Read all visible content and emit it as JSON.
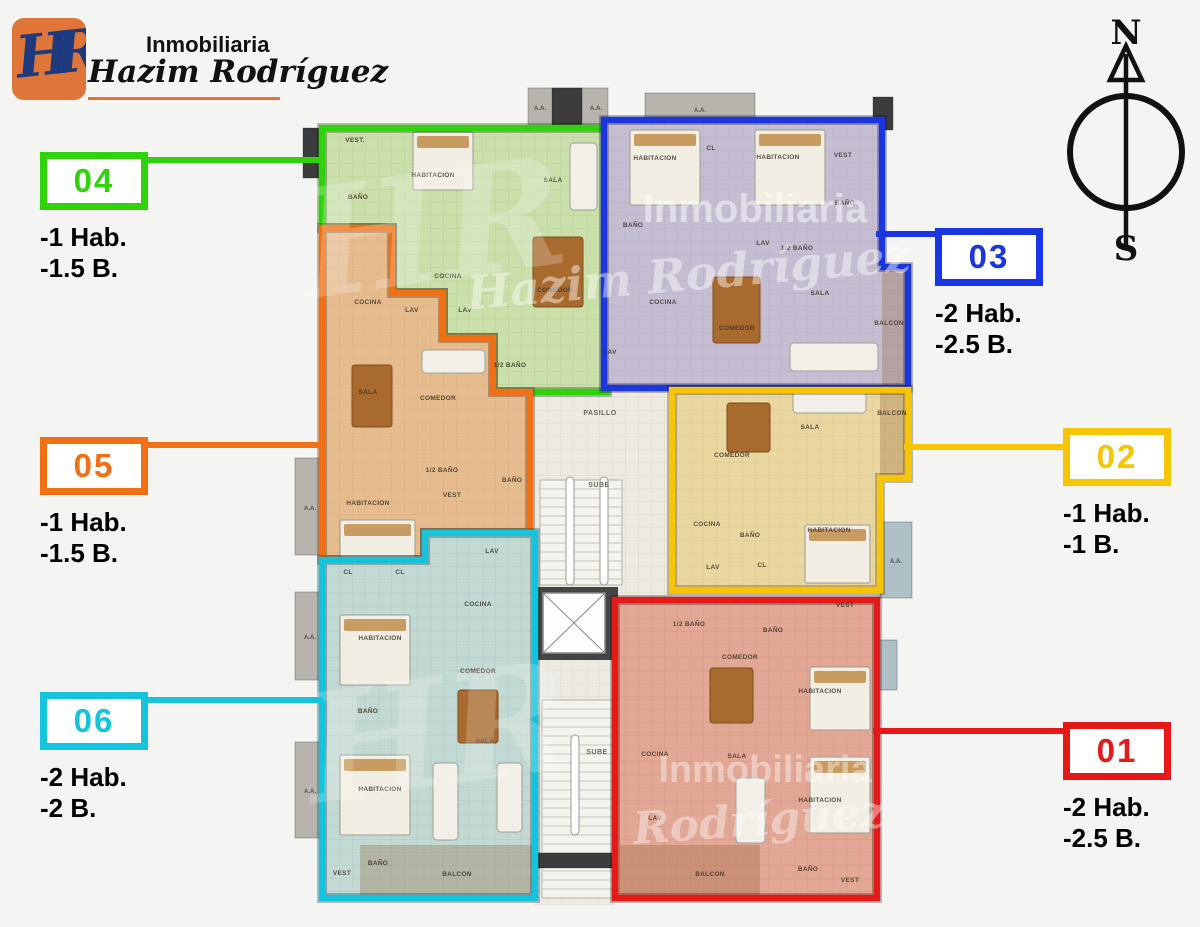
{
  "brand": {
    "monogram": "HR",
    "line1": "Inmobiliaria",
    "line2": "Hazim Rodríguez"
  },
  "compass": {
    "north": "N",
    "south": "S"
  },
  "units": {
    "01": {
      "id": "01",
      "hab": "-2 Hab.",
      "bath": "-2.5 B.",
      "color": "#e51a18",
      "fill": "#e2a795",
      "outline": "315,515 577,515 577,813 315,813",
      "rooms": [
        {
          "name": "1/2 BAÑO",
          "x": 389,
          "y": 541
        },
        {
          "name": "BAÑO",
          "x": 473,
          "y": 547
        },
        {
          "name": "VEST",
          "x": 545,
          "y": 522
        },
        {
          "name": "COMEDOR",
          "x": 440,
          "y": 574
        },
        {
          "name": "HABITACION",
          "x": 520,
          "y": 608
        },
        {
          "name": "COCINA",
          "x": 355,
          "y": 671
        },
        {
          "name": "SALA",
          "x": 437,
          "y": 673
        },
        {
          "name": "LAV",
          "x": 355,
          "y": 735
        },
        {
          "name": "HABITACION",
          "x": 520,
          "y": 717
        },
        {
          "name": "BALCON",
          "x": 410,
          "y": 791
        },
        {
          "name": "BAÑO",
          "x": 508,
          "y": 786
        },
        {
          "name": "VEST",
          "x": 550,
          "y": 797
        }
      ]
    },
    "02": {
      "id": "02",
      "hab": "-1 Hab.",
      "bath": "-1 B.",
      "color": "#f7c506",
      "fill": "#ead7a0",
      "outline": "372,305 608,305 608,393 580,393 580,505 372,505",
      "rooms": [
        {
          "name": "COMEDOR",
          "x": 432,
          "y": 372
        },
        {
          "name": "SALA",
          "x": 510,
          "y": 344
        },
        {
          "name": "BALCON",
          "x": 592,
          "y": 330
        },
        {
          "name": "COCINA",
          "x": 407,
          "y": 441
        },
        {
          "name": "BAÑO",
          "x": 450,
          "y": 452
        },
        {
          "name": "LAV",
          "x": 413,
          "y": 484
        },
        {
          "name": "CL",
          "x": 462,
          "y": 482
        },
        {
          "name": "HABITACION",
          "x": 529,
          "y": 447
        }
      ]
    },
    "03": {
      "id": "03",
      "hab": "-2 Hab.",
      "bath": "-2.5 B.",
      "color": "#1a36e0",
      "fill": "#c5bed2",
      "outline": "304,35 582,35 582,182 608,182 608,303 304,303",
      "rooms": [
        {
          "name": "HABITACION",
          "x": 355,
          "y": 75
        },
        {
          "name": "CL",
          "x": 411,
          "y": 65
        },
        {
          "name": "HABITACION",
          "x": 478,
          "y": 74
        },
        {
          "name": "VEST",
          "x": 543,
          "y": 72
        },
        {
          "name": "BAÑO",
          "x": 333,
          "y": 142
        },
        {
          "name": "BAÑO",
          "x": 545,
          "y": 120
        },
        {
          "name": "LAV",
          "x": 463,
          "y": 160
        },
        {
          "name": "1/2 BAÑO",
          "x": 497,
          "y": 165
        },
        {
          "name": "COCINA",
          "x": 363,
          "y": 219
        },
        {
          "name": "COMEDOR",
          "x": 437,
          "y": 245
        },
        {
          "name": "SALA",
          "x": 520,
          "y": 210
        },
        {
          "name": "BALCON",
          "x": 589,
          "y": 240
        },
        {
          "name": "LAV",
          "x": 310,
          "y": 269
        }
      ]
    },
    "04": {
      "id": "04",
      "hab": "-1 Hab.",
      "bath": "-1.5 B.",
      "color": "#2fd30b",
      "fill": "#cadfa9",
      "outline": "22,43 307,43 307,307 193,307 193,253 143,253 143,208 92,208 92,143 22,143",
      "rooms": [
        {
          "name": "VEST.",
          "x": 55,
          "y": 57
        },
        {
          "name": "BAÑO",
          "x": 58,
          "y": 114
        },
        {
          "name": "HABITACION",
          "x": 133,
          "y": 92
        },
        {
          "name": "SALA",
          "x": 253,
          "y": 97
        },
        {
          "name": "COCINA",
          "x": 148,
          "y": 193
        },
        {
          "name": "LAV",
          "x": 165,
          "y": 227
        },
        {
          "name": "COMEDOR",
          "x": 255,
          "y": 207
        },
        {
          "name": "1/2 BAÑO",
          "x": 210,
          "y": 282
        }
      ]
    },
    "05": {
      "id": "05",
      "hab": "-1 Hab.",
      "bath": "-1.5 B.",
      "color": "#f36f13",
      "fill": "#e6bc8e",
      "outline": "22,143 92,143 92,208 143,208 143,253 193,253 193,307 230,307 230,448 125,448 125,475 22,475",
      "rooms": [
        {
          "name": "COCINA",
          "x": 68,
          "y": 219
        },
        {
          "name": "LAV",
          "x": 112,
          "y": 227
        },
        {
          "name": "SALA",
          "x": 68,
          "y": 309
        },
        {
          "name": "COMEDOR",
          "x": 138,
          "y": 315
        },
        {
          "name": "1/2 BAÑO",
          "x": 142,
          "y": 387
        },
        {
          "name": "BAÑO",
          "x": 212,
          "y": 397
        },
        {
          "name": "VEST",
          "x": 152,
          "y": 412
        },
        {
          "name": "HABITACION",
          "x": 68,
          "y": 420
        },
        {
          "name": "CL",
          "x": 100,
          "y": 489
        }
      ]
    },
    "06": {
      "id": "06",
      "hab": "-2 Hab.",
      "bath": "-2 B.",
      "color": "#14c4dd",
      "fill": "#c3d9d3",
      "outline": "22,475 125,475 125,448 235,448 235,813 22,813",
      "rooms": [
        {
          "name": "CL",
          "x": 48,
          "y": 489
        },
        {
          "name": "LAV",
          "x": 192,
          "y": 468
        },
        {
          "name": "COCINA",
          "x": 178,
          "y": 521
        },
        {
          "name": "HABITACION",
          "x": 80,
          "y": 555
        },
        {
          "name": "COMEDOR",
          "x": 178,
          "y": 588
        },
        {
          "name": "BAÑO",
          "x": 68,
          "y": 628
        },
        {
          "name": "SALA",
          "x": 185,
          "y": 658
        },
        {
          "name": "HABITACION",
          "x": 80,
          "y": 706
        },
        {
          "name": "VEST",
          "x": 42,
          "y": 790
        },
        {
          "name": "BAÑO",
          "x": 78,
          "y": 780
        },
        {
          "name": "BALCON",
          "x": 157,
          "y": 791
        }
      ]
    }
  },
  "floorplan": {
    "order": [
      "04",
      "05",
      "06",
      "03",
      "02",
      "01"
    ],
    "corridor": {
      "fill": "#edeae3",
      "outline": "230,303 372,303 372,513 315,513 315,820 235,820 235,448 230,448",
      "labels": [
        {
          "text": "PASILLO",
          "x": 300,
          "y": 330
        },
        {
          "text": "SUBE",
          "x": 299,
          "y": 402
        },
        {
          "text": "SUBE",
          "x": 297,
          "y": 669
        }
      ]
    },
    "ac_label": "A.A.",
    "blocks": [
      {
        "x": 228,
        "y": 3,
        "w": 80,
        "h": 38,
        "fill": "#b7b4ae",
        "labels": [
          [
            240,
            25
          ],
          [
            296,
            25
          ]
        ]
      },
      {
        "x": 252,
        "y": 3,
        "w": 30,
        "h": 38,
        "fill": "#3c3c3c"
      },
      {
        "x": 345,
        "y": 8,
        "w": 110,
        "h": 32,
        "fill": "#b7b4ae",
        "labels": [
          [
            400,
            27
          ]
        ]
      },
      {
        "x": -5,
        "y": 373,
        "w": 30,
        "h": 97,
        "fill": "#b7b4ae",
        "labels": [
          [
            10,
            425
          ]
        ]
      },
      {
        "x": -5,
        "y": 507,
        "w": 30,
        "h": 88,
        "fill": "#b7b4ae",
        "labels": [
          [
            10,
            554
          ]
        ]
      },
      {
        "x": -5,
        "y": 657,
        "w": 30,
        "h": 96,
        "fill": "#b7b4ae",
        "labels": [
          [
            10,
            708
          ]
        ]
      },
      {
        "x": 580,
        "y": 437,
        "w": 32,
        "h": 76,
        "fill": "#aebfc6",
        "labels": [
          [
            596,
            478
          ]
        ]
      },
      {
        "x": 577,
        "y": 555,
        "w": 20,
        "h": 50,
        "fill": "#aebfc6"
      },
      {
        "x": 3,
        "y": 43,
        "w": 19,
        "h": 50,
        "fill": "#3c3c3c"
      },
      {
        "x": 573,
        "y": 12,
        "w": 20,
        "h": 33,
        "fill": "#3c3c3c"
      },
      {
        "x": 580,
        "y": 257,
        "w": 20,
        "h": 46,
        "fill": "#3c3c3c"
      },
      {
        "x": 238,
        "y": 768,
        "w": 77,
        "h": 15,
        "fill": "#3c3c3c"
      }
    ],
    "watermarks": [
      {
        "text": "Inmobiliaria",
        "x": 455,
        "y": 137,
        "size": 40,
        "italic": false,
        "opacity": 0.5,
        "rotate": 0
      },
      {
        "text": "Hazim Rodríguez",
        "x": 390,
        "y": 205,
        "size": 46,
        "italic": true,
        "opacity": 0.45,
        "rotate": -5
      },
      {
        "text": "HR",
        "x": 140,
        "y": 195,
        "size": 150,
        "italic": true,
        "opacity": 0.22,
        "rotate": -8
      },
      {
        "text": "Inmobiliaria",
        "x": 465,
        "y": 697,
        "size": 38,
        "italic": false,
        "opacity": 0.4,
        "rotate": 0
      },
      {
        "text": "Rodríguez",
        "x": 460,
        "y": 750,
        "size": 44,
        "italic": true,
        "opacity": 0.4,
        "rotate": -4
      },
      {
        "text": "HR",
        "x": 145,
        "y": 700,
        "size": 150,
        "italic": true,
        "opacity": 0.2,
        "rotate": -8
      }
    ]
  }
}
